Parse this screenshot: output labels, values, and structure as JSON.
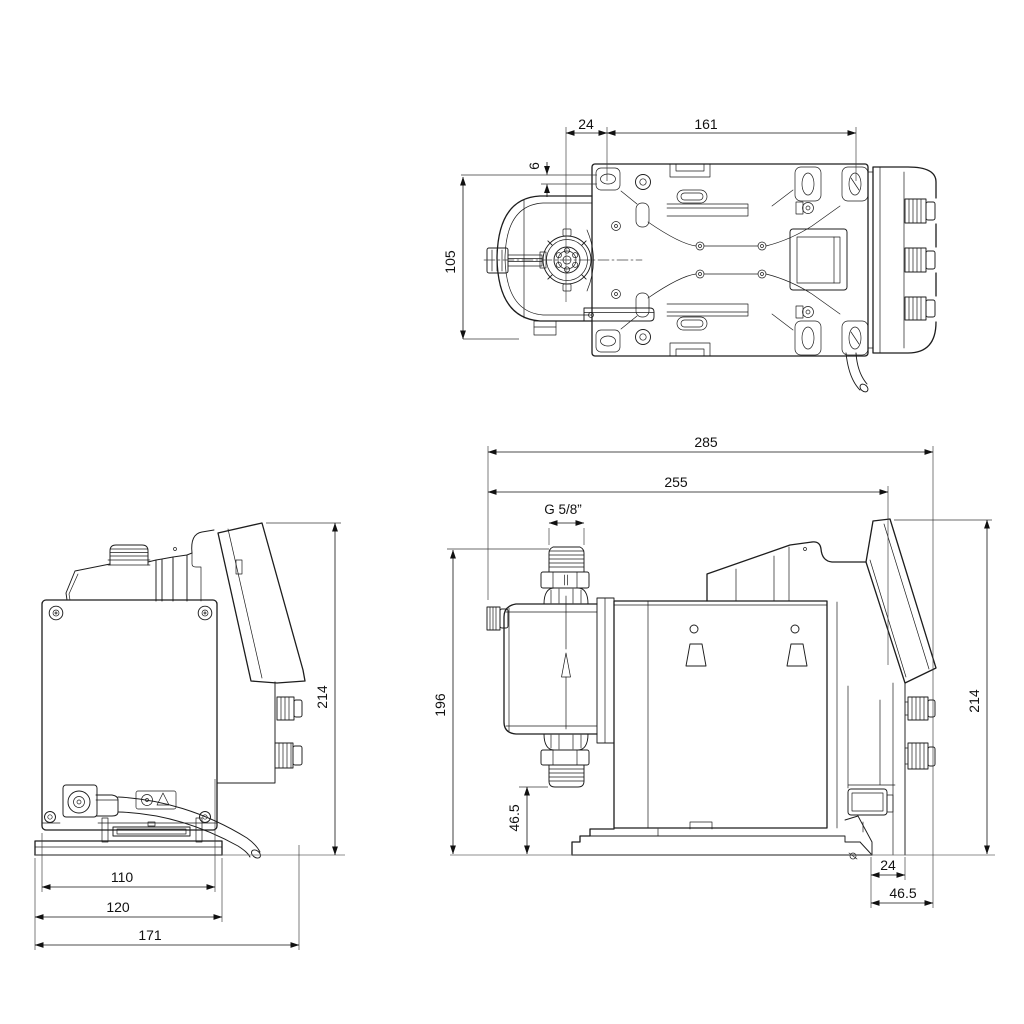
{
  "drawing": {
    "type": "technical-dimensional-drawing",
    "colors": {
      "line": "#1d1d1d",
      "dimension": "#111111",
      "ground": "#6a6a6a",
      "background": "#ffffff"
    }
  },
  "views": {
    "top": {
      "name": "top-view",
      "dims": {
        "d24": "24",
        "d161": "161",
        "d6": "6",
        "d105": "105"
      }
    },
    "front": {
      "name": "front-view",
      "dims": {
        "d214": "214",
        "d110": "110",
        "d120": "120",
        "d171": "171"
      }
    },
    "side": {
      "name": "side-view",
      "dims": {
        "d285": "285",
        "d255": "255",
        "thread": "G 5/8”",
        "d196": "196",
        "d46L": "46.5",
        "d214": "214",
        "d24": "24",
        "d46R": "46.5"
      }
    }
  }
}
